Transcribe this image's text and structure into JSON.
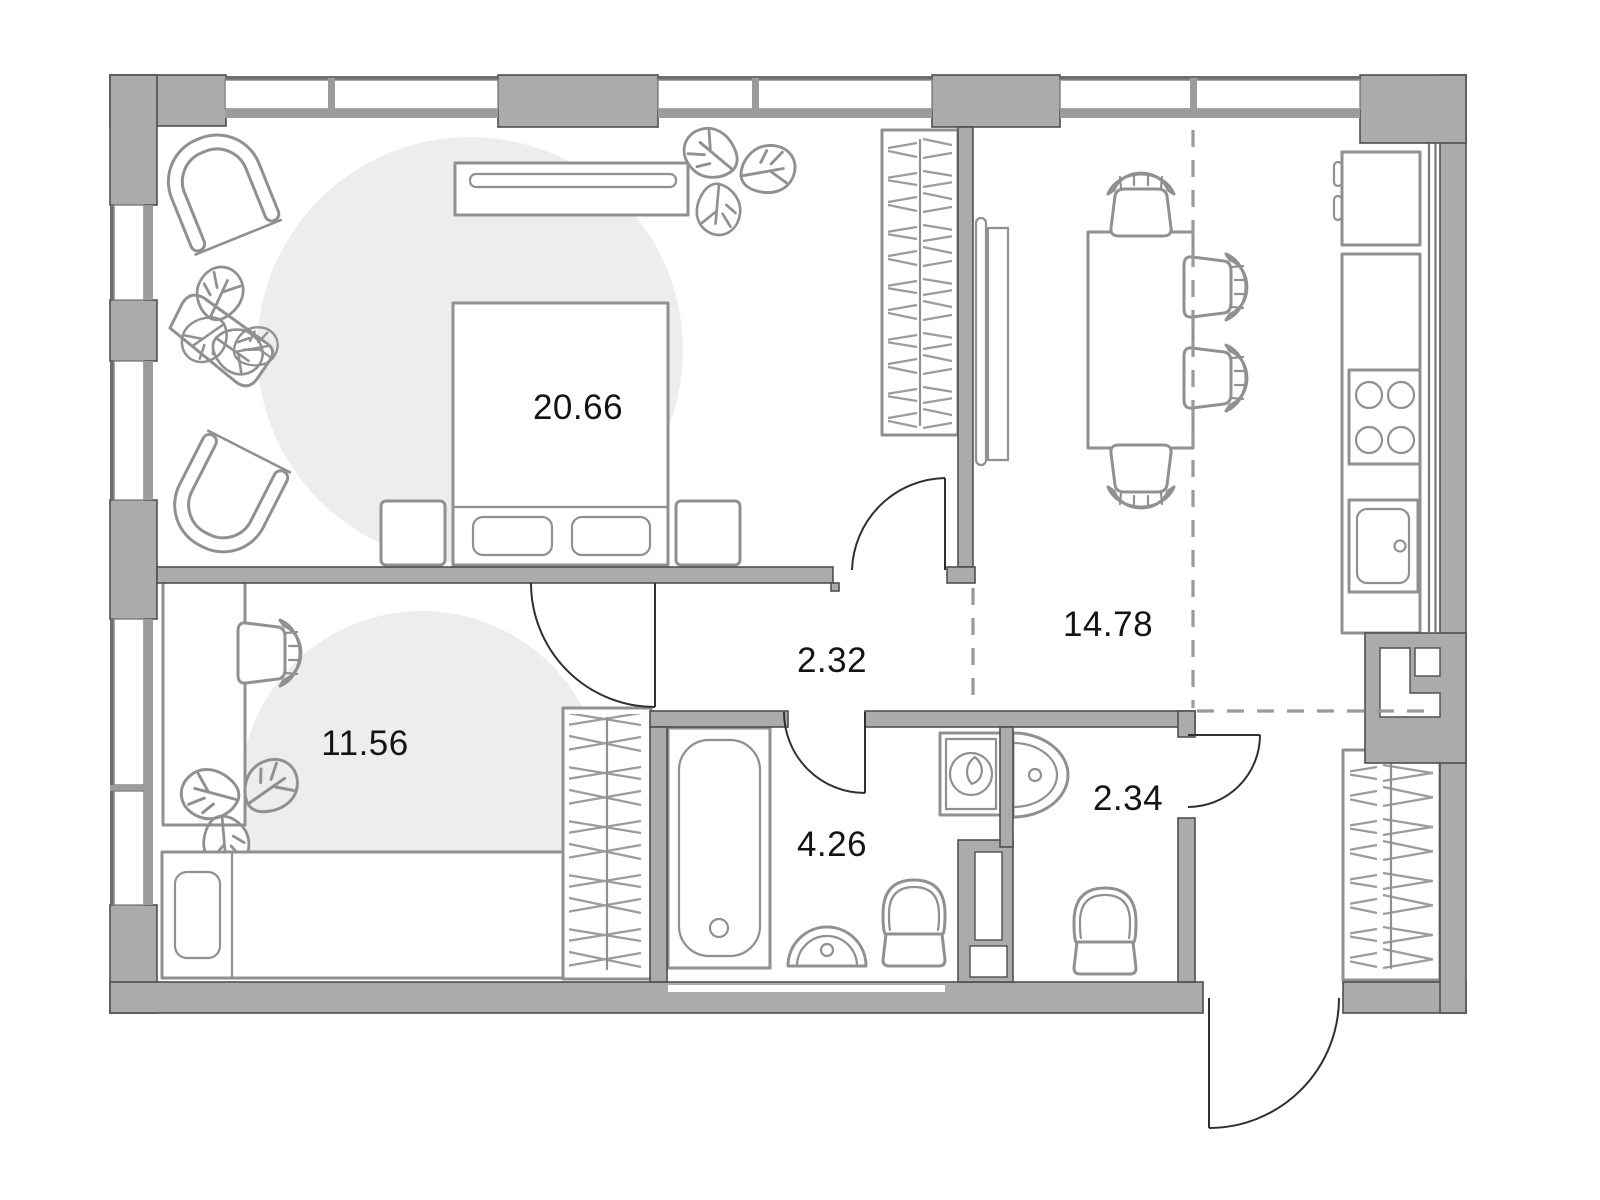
{
  "floor_plan": {
    "room_labels": {
      "bedroom": "20.66",
      "second_room": "11.56",
      "hallway": "2.32",
      "kitchen_living": "14.78",
      "bathroom": "4.26",
      "toilet": "2.34"
    },
    "colors": {
      "wall": "#ababab",
      "wall_outline": "#4f4f4f",
      "furniture_line": "#909090",
      "rug": "#ededed",
      "zone_dash": "#9a9a9a",
      "window_frame": "#8a8a8a",
      "label_text": "#141414"
    }
  }
}
